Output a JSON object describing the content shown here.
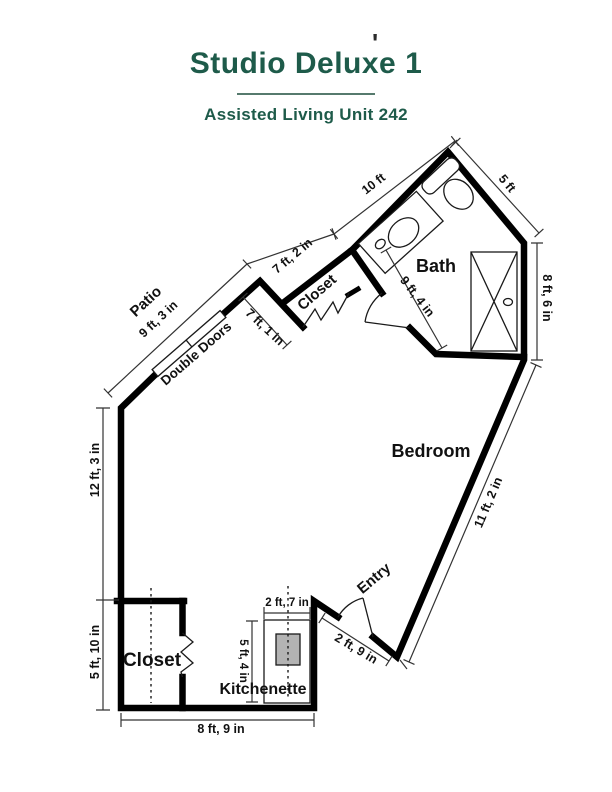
{
  "header": {
    "title": "Studio Deluxe 1",
    "subtitle": "Assisted Living Unit 242",
    "stray_mark": "'"
  },
  "plan": {
    "rooms": {
      "patio": "Patio",
      "closet_upper": "Closet",
      "bath": "Bath",
      "bedroom": "Bedroom",
      "entry": "Entry",
      "closet_lower": "Closet",
      "kitchenette": "Kitchenette"
    },
    "features": {
      "double_doors": "Double Doors"
    },
    "dims": {
      "patio": "9 ft, 3 in",
      "top_left_wall": "7 ft, 2 in",
      "closet_depth": "7 ft, 1 in",
      "top_wall": "10 ft",
      "top_right_wall": "5 ft",
      "right_wall": "8 ft, 6 in",
      "bath_width": "9 ft, 4 in",
      "bedroom_wall": "11 ft, 2 in",
      "entry_opening": "2 ft, 9 in",
      "left_wall_upper": "12 ft, 3 in",
      "left_wall_lower": "5 ft, 10 in",
      "bottom_wall": "8 ft, 9 in",
      "kitchenette_width": "2 ft, 7 in",
      "kitchenette_depth": "5 ft, 4 in"
    }
  },
  "colors": {
    "accent": "#1e5b4a",
    "divider": "#567a6d",
    "wall": "#000000",
    "dimension": "#333333",
    "appliance": "#b3b3b3"
  }
}
